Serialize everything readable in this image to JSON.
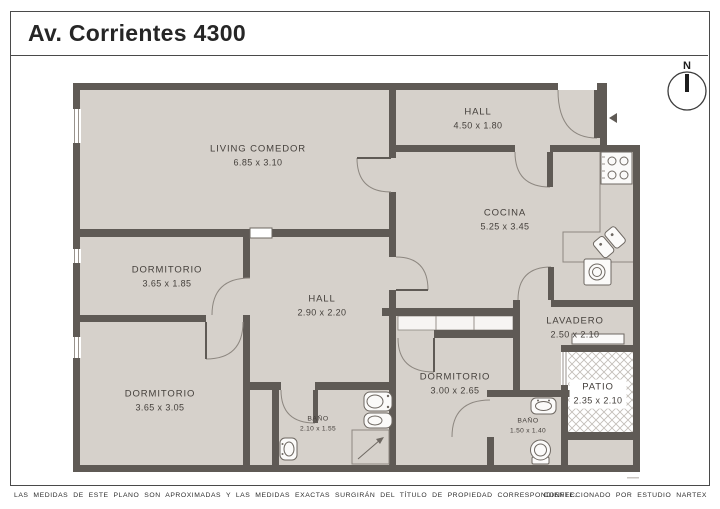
{
  "page": {
    "title": "Av. Corrientes 4300",
    "disclaimer": "LAS MEDIDAS DE ESTE PLANO SON APROXIMADAS Y LAS MEDIDAS EXACTAS SURGIRÁN DEL TÍTULO DE PROPIEDAD CORRESPONDIENTE.",
    "credit": "CONFECCIONADO POR ESTUDIO NARTEX"
  },
  "compass": {
    "label": "N"
  },
  "rooms": [
    {
      "name": "LIVING COMEDOR",
      "dims": "6.85 x 3.10",
      "x": 258,
      "y": 156,
      "small": false,
      "bg": false
    },
    {
      "name": "HALL",
      "dims": "4.50 x 1.80",
      "x": 478,
      "y": 119,
      "small": false,
      "bg": false
    },
    {
      "name": "COCINA",
      "dims": "5.25 x 3.45",
      "x": 505,
      "y": 220,
      "small": false,
      "bg": false
    },
    {
      "name": "DORMITORIO",
      "dims": "3.65 x 1.85",
      "x": 167,
      "y": 277,
      "small": false,
      "bg": false
    },
    {
      "name": "HALL",
      "dims": "2.90 x 2.20",
      "x": 322,
      "y": 306,
      "small": false,
      "bg": false
    },
    {
      "name": "LAVADERO",
      "dims": "2.50 x 2.10",
      "x": 575,
      "y": 328,
      "small": false,
      "bg": false
    },
    {
      "name": "DORMITORIO",
      "dims": "3.65 x 3.05",
      "x": 160,
      "y": 401,
      "small": false,
      "bg": false
    },
    {
      "name": "DORMITORIO",
      "dims": "3.00 x 2.65",
      "x": 455,
      "y": 384,
      "small": false,
      "bg": false
    },
    {
      "name": "BAÑO",
      "dims": "2.10 x 1.55",
      "x": 318,
      "y": 424,
      "small": true,
      "bg": false
    },
    {
      "name": "BAÑO",
      "dims": "1.50 x 1.40",
      "x": 528,
      "y": 426,
      "small": true,
      "bg": false
    },
    {
      "name": "PATIO",
      "dims": "2.35 x 2.10",
      "x": 598,
      "y": 394,
      "small": false,
      "bg": true
    }
  ],
  "colors": {
    "wall": "#5f5a55",
    "floor": "#d6d1cb",
    "frame": "#4a4a4a",
    "hatch": "#c3beb8"
  }
}
